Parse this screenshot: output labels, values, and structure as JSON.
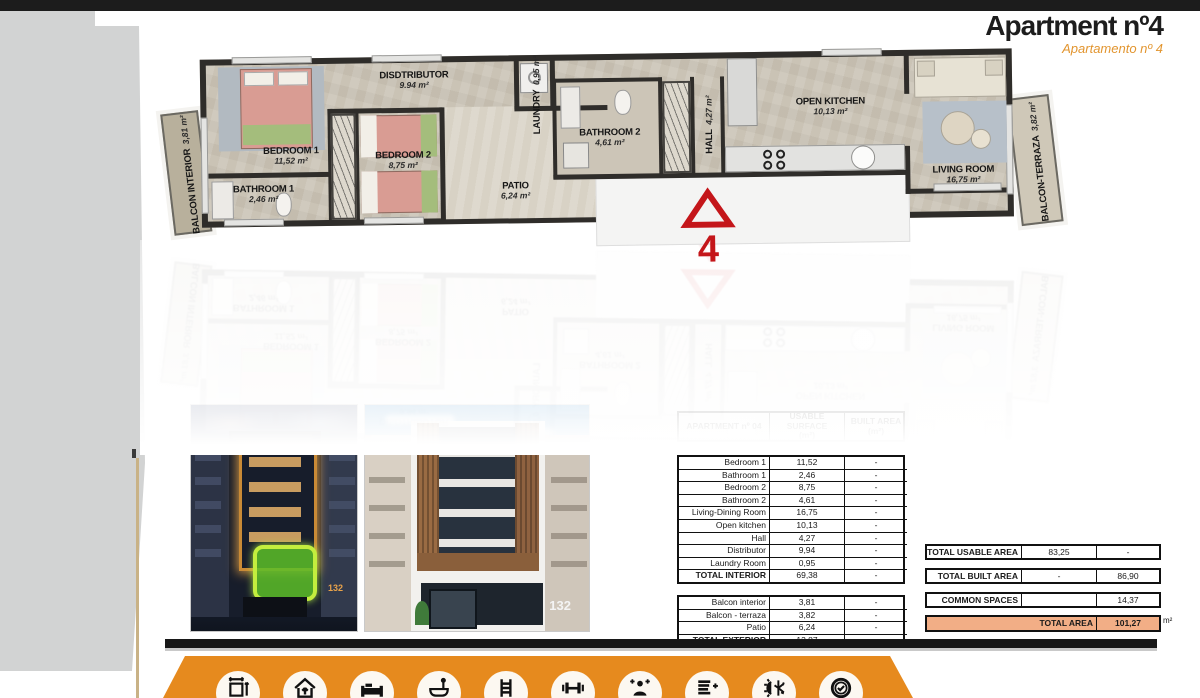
{
  "header": {
    "title": "Apartment nº4",
    "subtitle": "Apartamento nº 4"
  },
  "floorplan": {
    "rooms": [
      {
        "name": "BEDROOM 1",
        "area": "11,52 m²"
      },
      {
        "name": "BATHROOM 1",
        "area": "2,46 m²"
      },
      {
        "name": "DISDTRIBUTOR",
        "area": "9.94 m²"
      },
      {
        "name": "BEDROOM 2",
        "area": "8,75 m²"
      },
      {
        "name": "PATIO",
        "area": "6,24 m²"
      },
      {
        "name": "LAUNDRY",
        "area": "0,95 m²"
      },
      {
        "name": "BATHROOM 2",
        "area": "4,61 m²"
      },
      {
        "name": "HALL",
        "area": "4,27 m²"
      },
      {
        "name": "OPEN KITCHEN",
        "area": "10,13 m²"
      },
      {
        "name": "LIVING ROOM",
        "area": "16,75 m²"
      },
      {
        "name": "BALCON INTERIOR",
        "area": "3,81 m²"
      },
      {
        "name": "BALCON-TERRAZA",
        "area": "3,82 m²"
      }
    ],
    "unit_marker": "4"
  },
  "photos": {
    "left_number": "132",
    "right_number": "132"
  },
  "area_table": {
    "header": {
      "col1": "APARTMENT nº 04",
      "col2_line1": "USABLE SURFACE",
      "col2_line2": "(m²)",
      "col3_line1": "BUILT AREA",
      "col3_line2": "(m²)"
    },
    "interior_rows": [
      {
        "label": "Bedroom 1",
        "usable": "11,52",
        "built": "-"
      },
      {
        "label": "Bathroom 1",
        "usable": "2,46",
        "built": "-"
      },
      {
        "label": "Bedroom 2",
        "usable": "8,75",
        "built": "-"
      },
      {
        "label": "Bathroom 2",
        "usable": "4,61",
        "built": "-"
      },
      {
        "label": "Living-Dining Room",
        "usable": "16,75",
        "built": "-"
      },
      {
        "label": "Open kitchen",
        "usable": "10,13",
        "built": "-"
      },
      {
        "label": "Hall",
        "usable": "4,27",
        "built": "-"
      },
      {
        "label": "Distributor",
        "usable": "9,94",
        "built": "-"
      },
      {
        "label": "Laundry Room",
        "usable": "0,95",
        "built": "-"
      },
      {
        "label": "TOTAL INTERIOR",
        "usable": "69,38",
        "built": "-"
      }
    ],
    "exterior_rows": [
      {
        "label": "Balcon interior",
        "usable": "3,81",
        "built": "-"
      },
      {
        "label": "Balcon - terraza",
        "usable": "3,82",
        "built": "-"
      },
      {
        "label": "Patio",
        "usable": "6,24",
        "built": "-"
      },
      {
        "label": "TOTAL EXTERIOR",
        "usable": "13,87",
        "built": "-"
      }
    ],
    "summary_rows": [
      {
        "label": "TOTAL USABLE AREA",
        "usable": "83,25",
        "built": "-"
      },
      {
        "label": "TOTAL BUILT AREA",
        "usable": "-",
        "built": "86,90"
      },
      {
        "label": "COMMON SPACES",
        "usable": "",
        "built": "14,37"
      }
    ],
    "total_row": {
      "label": "TOTAL AREA",
      "value": "101,27",
      "unit": "m²"
    }
  },
  "footer": {
    "icons": [
      "surface-dimensions",
      "house-arrow",
      "bed",
      "bathtub",
      "pool-ladder",
      "gym-dumbbell",
      "spa-person",
      "energy-rating-plus",
      "climate-sun-snowflake",
      "quality-check-badge"
    ]
  },
  "colors": {
    "accent_orange": "#e68a1e",
    "subtitle_orange": "#e2952f",
    "total_row_fill": "#f2ae86",
    "marker_red": "#c4161a"
  }
}
